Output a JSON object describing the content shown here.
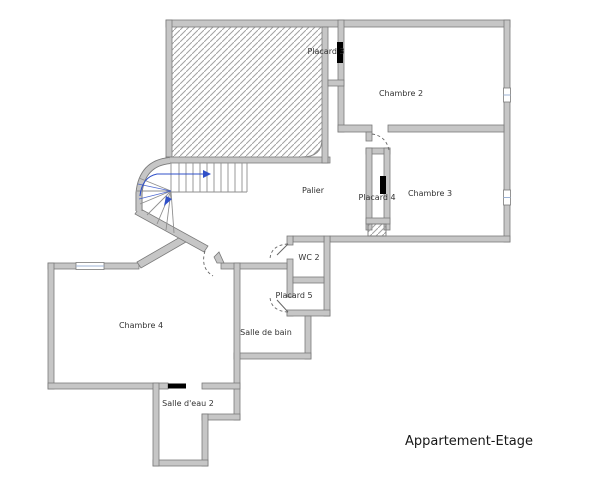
{
  "title": "Appartement-Etage",
  "rooms": [
    {
      "id": "placard-3",
      "label": "Placard 3"
    },
    {
      "id": "chambre-2",
      "label": "Chambre 2"
    },
    {
      "id": "palier",
      "label": "Palier"
    },
    {
      "id": "placard-4",
      "label": "Placard 4"
    },
    {
      "id": "chambre-3",
      "label": "Chambre 3"
    },
    {
      "id": "wc-2",
      "label": "WC 2"
    },
    {
      "id": "placard-5",
      "label": "Placard 5"
    },
    {
      "id": "chambre-4",
      "label": "Chambre 4"
    },
    {
      "id": "salle-de-bain",
      "label": "Salle de bain"
    },
    {
      "id": "salle-eau-2",
      "label": "Salle d'eau 2"
    }
  ],
  "colors": {
    "wall_fill": "#c6c6c6",
    "wall_edge": "#7a7a7a",
    "hatch": "#a2a2a2",
    "tread_line": "#8f8f8f",
    "walkline_blue": "#3050c8",
    "door_arc": "#666666",
    "door_leaf_black": "#000000",
    "window_line": "#9db3d6",
    "label_text": "#333333"
  }
}
